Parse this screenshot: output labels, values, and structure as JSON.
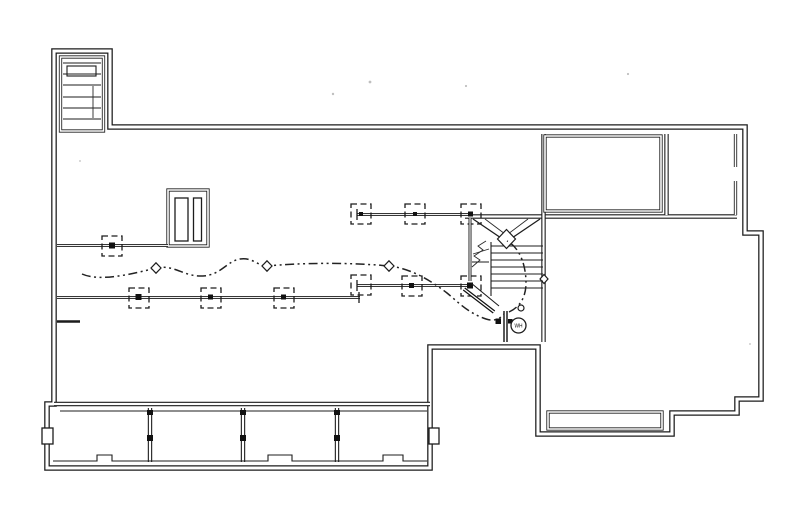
{
  "drawing": {
    "kind": "scanned-floor-plan",
    "palette": {
      "ink": "#1c1c1c",
      "paper": "#ffffff"
    },
    "labels": {
      "water_heater": "WH"
    },
    "elements": {
      "stair_bulkhead": {
        "treads": 6
      },
      "main_stair": {
        "treads": 7,
        "style": "winder-with-diagonals"
      },
      "support_beams": 4,
      "dashed_post_footings": 10,
      "utility_line_diamond_markers": 3,
      "porch_bays": 4,
      "chimney_slots": 2
    }
  }
}
